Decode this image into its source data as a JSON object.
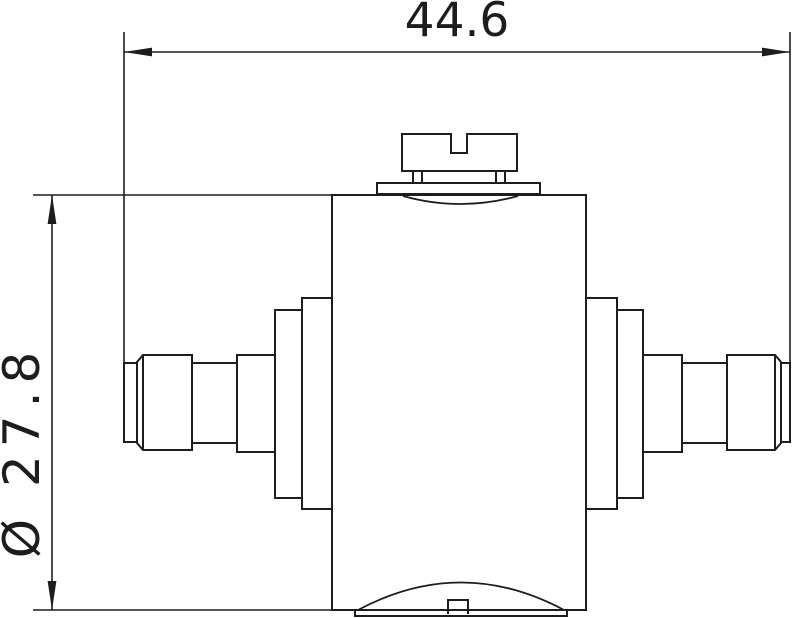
{
  "drawing": {
    "kind": "technical-dimension-drawing",
    "dimensions": [
      {
        "id": "overall-length",
        "label": "44.6",
        "orientation": "horizontal"
      },
      {
        "id": "body-diameter",
        "label": "Ø 27.8",
        "orientation": "vertical"
      }
    ],
    "colors": {
      "line": "#1d1d1d",
      "background": "#ffffff"
    }
  }
}
